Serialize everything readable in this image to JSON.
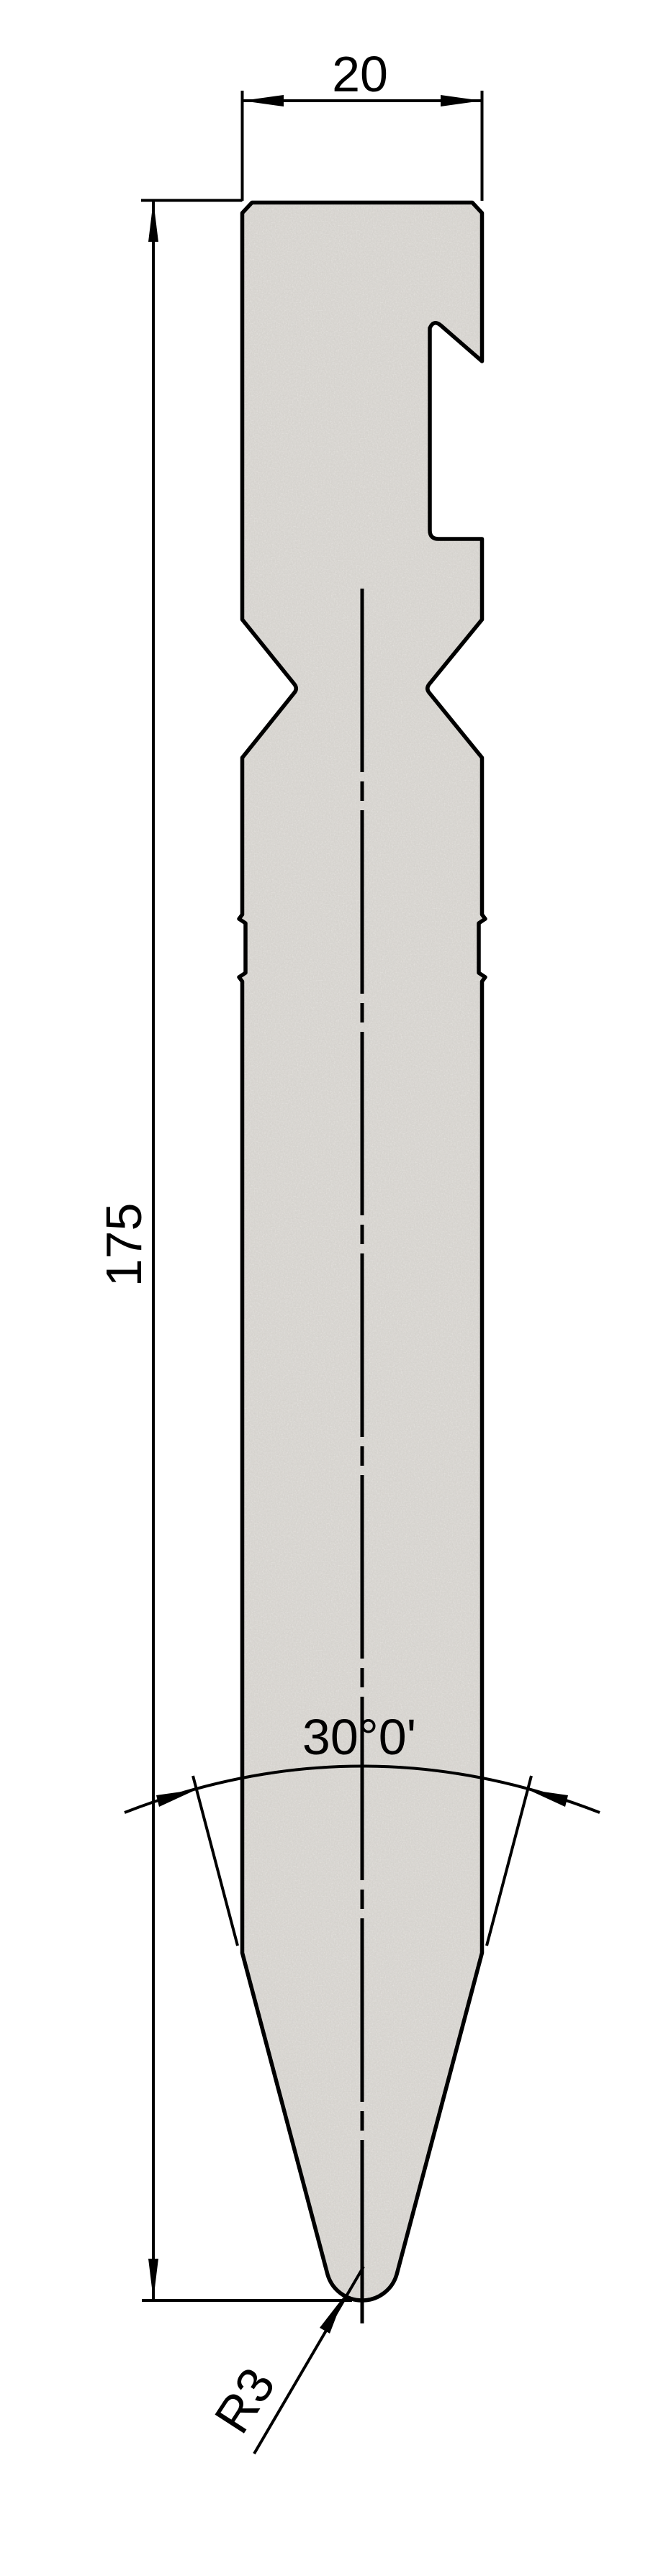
{
  "drawing": {
    "labels": {
      "width": "20",
      "height": "175",
      "tip_angle": "30°0'",
      "tip_radius": "R3"
    },
    "colors": {
      "line": "#000000",
      "part_fill": "#d4d1cc",
      "background": "#ffffff"
    }
  }
}
